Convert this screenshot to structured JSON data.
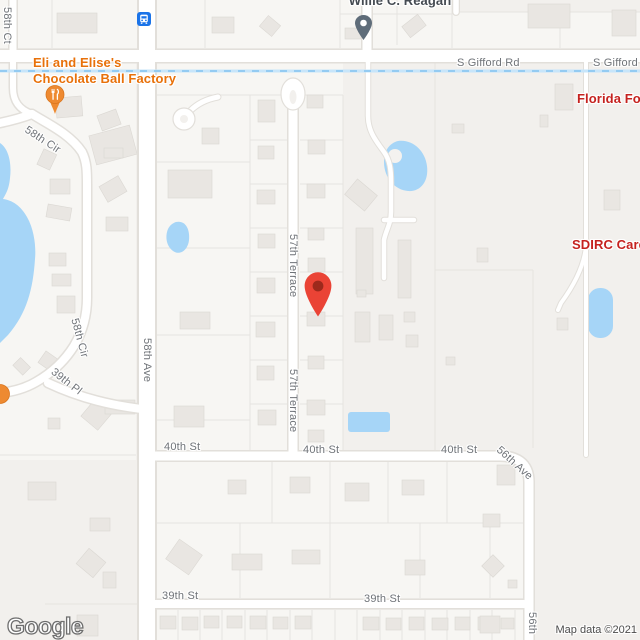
{
  "map": {
    "provider_logo": "Google",
    "attribution": "Map data ©2021"
  },
  "pois": {
    "reagan": {
      "name": "Willie C. Reagan"
    },
    "chocolate_factory": {
      "name_line1": "Eli and Elise's",
      "name_line2": "Chocolate Ball Factory"
    },
    "florida": {
      "name": "Florida For"
    },
    "sdirc": {
      "name": "SDIRC Care"
    }
  },
  "streets": {
    "ct58": "58th Ct",
    "gifford_a": "S Gifford Rd",
    "gifford_b": "S Gifford Rd",
    "cir58_a": "58th Cir",
    "cir58_b": "58th Cir",
    "terrace57_a": "57th Terrace",
    "terrace57_b": "57th Terrace",
    "ave58": "58th Ave",
    "pl39": "39th Pl",
    "st40_a": "40th St",
    "st40_b": "40th St",
    "st40_c": "40th St",
    "ave56_a": "56th Ave",
    "ave56_b": "56th",
    "st39_a": "39th St",
    "st39_b": "39th St"
  },
  "icons": {
    "transit": "bus-station-icon",
    "reagan_pin": "place-pin-icon",
    "restaurant_pin": "restaurant-pin-icon",
    "destination": "destination-marker-icon",
    "edge_poi": "poi-dot-icon"
  },
  "colors": {
    "marker_red": "#EA4335",
    "poi_orange": "#E8710A",
    "poi_red": "#C5221F",
    "water": "#A6D5F7",
    "transit_blue": "#1A73E8"
  }
}
